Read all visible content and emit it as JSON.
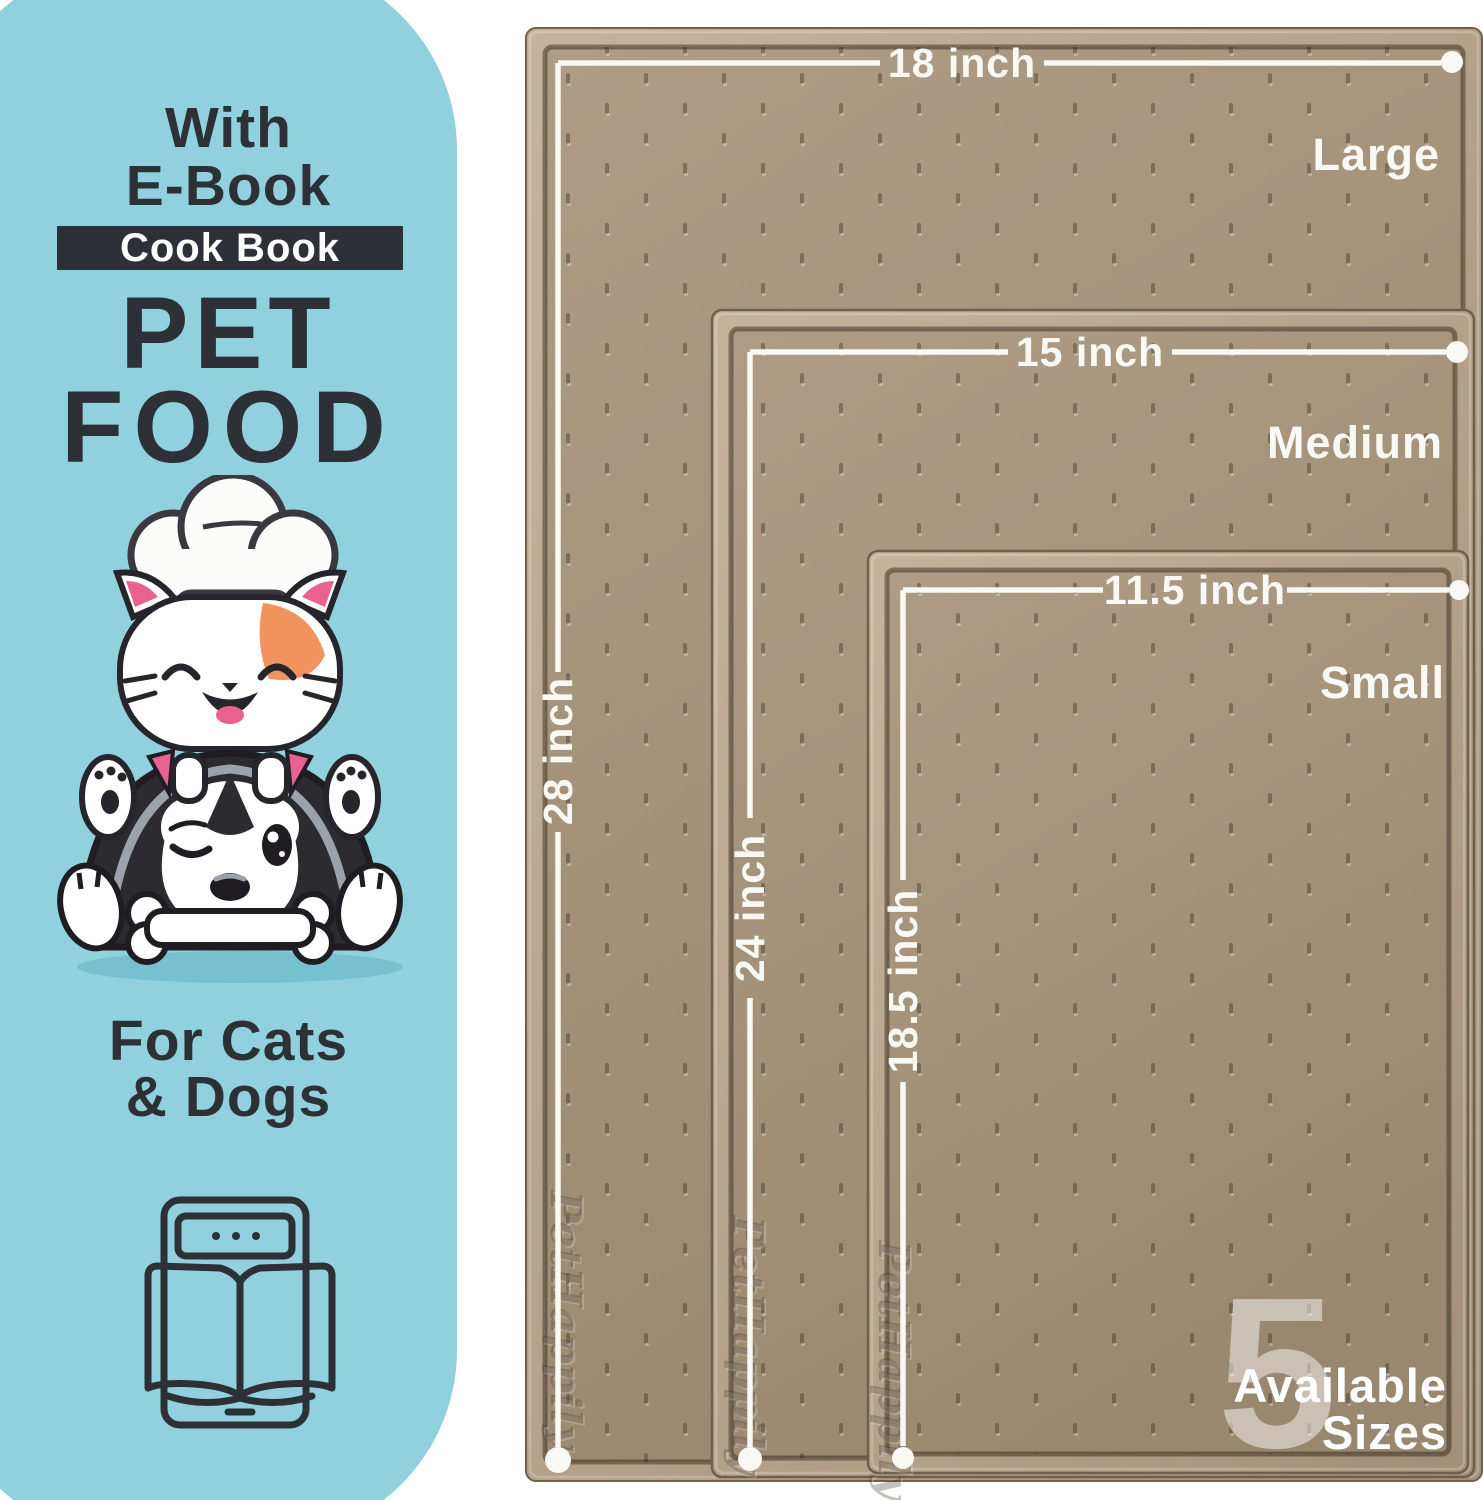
{
  "panel": {
    "title_line1": "With",
    "title_line2": "E-Book",
    "badge_label": "Cook Book",
    "heading_line1": "PET",
    "heading_line2": "FOOD",
    "footer_line1": "For Cats",
    "footer_line2": "& Dogs"
  },
  "mats": {
    "brand_watermark": "PetHappily",
    "items": [
      {
        "name": "Large",
        "width_label": "18 inch",
        "height_label": "28 inch"
      },
      {
        "name": "Medium",
        "width_label": "15 inch",
        "height_label": "24 inch"
      },
      {
        "name": "Small",
        "width_label": "11.5 inch",
        "height_label": "18.5 inch"
      }
    ]
  },
  "sizes_badge": {
    "count": "5",
    "line1": "Available",
    "line2": "Sizes"
  },
  "colors": {
    "panel_bg": "#91D1DD",
    "ink": "#2D3036",
    "badge_text": "#FFFFFF",
    "mat_rim": "#B7A48D",
    "mat_surface": "#A6937E",
    "mat_dark": "#5C4D3C",
    "dim_white": "#FAF8F2",
    "cat_orange": "#F0935C",
    "pink": "#E9628F",
    "shadow_blue": "#63B2C5"
  }
}
